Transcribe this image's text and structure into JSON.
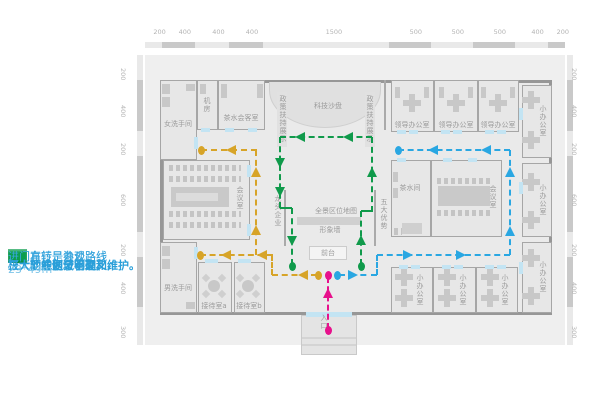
{
  "legend": {
    "items": [
      {
        "name": "office-route",
        "color": "#29abe2",
        "label": "进门右转是办公路线"
      },
      {
        "name": "negotiation-route",
        "color": "#d4a62a",
        "label": "进门左转是洽谈路线"
      },
      {
        "name": "tour-route",
        "color": "#0c9e4e",
        "label": "进门直行是参观路线"
      }
    ],
    "notes": [
      "三大动线划分明确,",
      "三大功能区域不交叉,",
      "极大的方便了管理和维护。"
    ],
    "dimensions": "23*49m"
  },
  "plan": {
    "dimensions_top": [
      200,
      400,
      400,
      400,
      1500,
      500,
      500,
      500,
      400,
      200
    ],
    "dimensions_side": [
      200,
      400,
      200,
      600,
      200,
      400,
      300
    ],
    "rooms": [
      {
        "name": "room-women-restroom",
        "label": "女洗手间",
        "x": 160,
        "y": 80,
        "w": 37,
        "h": 80,
        "o": "h",
        "lx": 178,
        "ly": 124
      },
      {
        "name": "room-machine",
        "label": "机房",
        "x": 197,
        "y": 80,
        "w": 21,
        "h": 50,
        "o": "v",
        "lx": 207,
        "ly": 105
      },
      {
        "name": "room-tea-reception",
        "label": "茶水会客室",
        "x": 218,
        "y": 80,
        "w": 47,
        "h": 50,
        "o": "h",
        "lx": 241,
        "ly": 118
      },
      {
        "name": "room-leader-office-1",
        "label": "领导办公室",
        "x": 391,
        "y": 80,
        "w": 43,
        "h": 52,
        "o": "h",
        "lx": 412,
        "ly": 125
      },
      {
        "name": "room-leader-office-2",
        "label": "领导办公室",
        "x": 434,
        "y": 80,
        "w": 44,
        "h": 52,
        "o": "h",
        "lx": 456,
        "ly": 125
      },
      {
        "name": "room-leader-office-3",
        "label": "领导办公室",
        "x": 478,
        "y": 80,
        "w": 41,
        "h": 52,
        "o": "h",
        "lx": 498,
        "ly": 125
      },
      {
        "name": "room-small-office-top-right",
        "label": "小办公室",
        "x": 522,
        "y": 85,
        "w": 30,
        "h": 73,
        "o": "v",
        "lx": 543,
        "ly": 121
      },
      {
        "name": "room-conference-left",
        "label": "会议室",
        "x": 163,
        "y": 160,
        "w": 87,
        "h": 80,
        "o": "v",
        "lx": 240,
        "ly": 198
      },
      {
        "name": "room-tea",
        "label": "茶水间",
        "x": 391,
        "y": 160,
        "w": 40,
        "h": 77,
        "o": "h",
        "lx": 410,
        "ly": 188
      },
      {
        "name": "room-conference-right",
        "label": "会议室",
        "x": 431,
        "y": 160,
        "w": 71,
        "h": 77,
        "o": "v",
        "lx": 493,
        "ly": 197
      },
      {
        "name": "room-small-office-mid-right",
        "label": "小办公室",
        "x": 522,
        "y": 163,
        "w": 30,
        "h": 74,
        "o": "v",
        "lx": 543,
        "ly": 200
      },
      {
        "name": "room-men-restroom",
        "label": "男洗手间",
        "x": 160,
        "y": 242,
        "w": 37,
        "h": 71,
        "o": "h",
        "lx": 178,
        "ly": 288
      },
      {
        "name": "room-reception-a",
        "label": "接待室a",
        "x": 198,
        "y": 262,
        "w": 34,
        "h": 51,
        "o": "h",
        "lx": 214,
        "ly": 306
      },
      {
        "name": "room-reception-b",
        "label": "接待室b",
        "x": 234,
        "y": 262,
        "w": 31,
        "h": 51,
        "o": "h",
        "lx": 249,
        "ly": 306
      },
      {
        "name": "room-small-office-b1",
        "label": "小办公室",
        "x": 391,
        "y": 267,
        "w": 42,
        "h": 46,
        "o": "v",
        "lx": 420,
        "ly": 290
      },
      {
        "name": "room-small-office-b2",
        "label": "小办公室",
        "x": 433,
        "y": 267,
        "w": 43,
        "h": 46,
        "o": "v",
        "lx": 463,
        "ly": 290
      },
      {
        "name": "room-small-office-b3",
        "label": "小办公室",
        "x": 476,
        "y": 267,
        "w": 42,
        "h": 46,
        "o": "v",
        "lx": 505,
        "ly": 290
      },
      {
        "name": "room-small-office-bottom-right",
        "label": "小办公室",
        "x": 522,
        "y": 242,
        "w": 30,
        "h": 71,
        "o": "v",
        "lx": 543,
        "ly": 277
      }
    ],
    "area_labels": [
      {
        "name": "label-tech-sandbox",
        "text": "科技沙盘",
        "x": 328,
        "y": 106,
        "o": "h"
      },
      {
        "name": "label-policy-display-left",
        "text": "政策扶持展示",
        "x": 283,
        "y": 119,
        "o": "v"
      },
      {
        "name": "label-policy-display-right",
        "text": "政策扶持展示",
        "x": 370,
        "y": 119,
        "o": "v"
      },
      {
        "name": "label-leading-enterprise",
        "text": "龙头企业",
        "x": 278,
        "y": 211,
        "o": "v"
      },
      {
        "name": "label-five-advantages",
        "text": "五大优势",
        "x": 384,
        "y": 214,
        "o": "v"
      },
      {
        "name": "label-panorama-map",
        "text": "全景区位地图",
        "x": 336,
        "y": 211,
        "o": "h"
      },
      {
        "name": "label-image-wall",
        "text": "形象墙",
        "x": 330,
        "y": 230,
        "o": "h"
      },
      {
        "name": "label-front-desk",
        "text": "前台",
        "x": 328,
        "y": 253,
        "o": "h"
      },
      {
        "name": "label-entrance",
        "text": "入口",
        "x": 324,
        "y": 322,
        "o": "v"
      }
    ],
    "features": [
      {
        "name": "entrance-vestibule",
        "t": "rect",
        "x": 301,
        "y": 315,
        "w": 56,
        "h": 40,
        "c": "#e4e4e4",
        "br": "#c9c9c9"
      },
      {
        "name": "vestibule-step",
        "t": "rect",
        "x": 302,
        "y": 337,
        "w": 54,
        "h": 2,
        "c": "#d4d4d4"
      },
      {
        "name": "vestibule-step",
        "t": "rect",
        "x": 302,
        "y": 344,
        "w": 54,
        "h": 2,
        "c": "#d4d4d4"
      },
      {
        "name": "tech-sandbox-stage",
        "t": "arch",
        "x": 269,
        "y": 82,
        "w": 112,
        "h": 46
      },
      {
        "name": "display-wall-left",
        "t": "rect",
        "x": 277,
        "y": 92,
        "w": 10,
        "h": 55,
        "c": "#e1e1e1"
      },
      {
        "name": "display-wall-right",
        "t": "rect",
        "x": 365,
        "y": 92,
        "w": 10,
        "h": 55,
        "c": "#e1e1e1"
      },
      {
        "name": "hall-wall-right",
        "t": "rect",
        "x": 384,
        "y": 80,
        "w": 2,
        "h": 50,
        "c": "#aaaaaa"
      },
      {
        "name": "hall-wall-stub-left",
        "t": "rect",
        "x": 284,
        "y": 190,
        "w": 2,
        "h": 56,
        "c": "#aaaaaa"
      },
      {
        "name": "hall-wall-stub-right",
        "t": "rect",
        "x": 374,
        "y": 190,
        "w": 2,
        "h": 56,
        "c": "#aaaaaa"
      },
      {
        "name": "image-wall",
        "t": "rect",
        "x": 297,
        "y": 217,
        "w": 64,
        "h": 8,
        "c": "#d0d0d0"
      },
      {
        "name": "front-desk",
        "t": "rect",
        "x": 309,
        "y": 246,
        "w": 38,
        "h": 14,
        "c": "#f4f4f4",
        "br": "#cccccc"
      },
      {
        "name": "entrance-door",
        "t": "rect",
        "x": 306,
        "y": 312,
        "w": 46,
        "h": 5,
        "c": "#c3e4f3"
      }
    ],
    "furniture": [
      {
        "t": "strip",
        "x": 169,
        "y": 165,
        "w": 72,
        "h": 6
      },
      {
        "t": "strip",
        "x": 169,
        "y": 176,
        "w": 72,
        "h": 6
      },
      {
        "t": "rect",
        "x": 171,
        "y": 187,
        "w": 58,
        "h": 20,
        "c": "#c9c9c9"
      },
      {
        "t": "rect",
        "x": 176,
        "y": 193,
        "w": 42,
        "h": 8,
        "c": "#dcdcdc"
      },
      {
        "t": "strip",
        "x": 169,
        "y": 211,
        "w": 72,
        "h": 6
      },
      {
        "t": "strip",
        "x": 169,
        "y": 222,
        "w": 72,
        "h": 6
      },
      {
        "t": "strip",
        "x": 437,
        "y": 178,
        "w": 54,
        "h": 6
      },
      {
        "t": "rect",
        "x": 438,
        "y": 186,
        "w": 52,
        "h": 20,
        "c": "#c9c9c9"
      },
      {
        "t": "strip",
        "x": 437,
        "y": 210,
        "w": 54,
        "h": 6
      },
      {
        "t": "plus",
        "x": 412,
        "y": 103
      },
      {
        "t": "rect",
        "x": 395,
        "y": 87,
        "w": 5,
        "h": 11
      },
      {
        "t": "rect",
        "x": 424,
        "y": 87,
        "w": 5,
        "h": 11
      },
      {
        "t": "plus",
        "x": 456,
        "y": 103
      },
      {
        "t": "rect",
        "x": 439,
        "y": 87,
        "w": 5,
        "h": 11
      },
      {
        "t": "rect",
        "x": 468,
        "y": 87,
        "w": 5,
        "h": 11
      },
      {
        "t": "plus",
        "x": 498,
        "y": 103
      },
      {
        "t": "rect",
        "x": 481,
        "y": 87,
        "w": 5,
        "h": 11
      },
      {
        "t": "rect",
        "x": 510,
        "y": 87,
        "w": 5,
        "h": 11
      },
      {
        "t": "plus",
        "x": 531,
        "y": 100
      },
      {
        "t": "plus",
        "x": 531,
        "y": 140
      },
      {
        "t": "plus",
        "x": 531,
        "y": 182
      },
      {
        "t": "plus",
        "x": 531,
        "y": 220
      },
      {
        "t": "plus",
        "x": 531,
        "y": 258
      },
      {
        "t": "plus",
        "x": 531,
        "y": 296
      },
      {
        "t": "plus",
        "x": 404,
        "y": 277
      },
      {
        "t": "plus",
        "x": 404,
        "y": 298
      },
      {
        "t": "plus",
        "x": 447,
        "y": 277
      },
      {
        "t": "plus",
        "x": 447,
        "y": 298
      },
      {
        "t": "plus",
        "x": 490,
        "y": 277
      },
      {
        "t": "plus",
        "x": 490,
        "y": 298
      },
      {
        "t": "circle",
        "x": 214,
        "y": 286,
        "r": 6
      },
      {
        "t": "diam",
        "x": 206,
        "y": 278
      },
      {
        "t": "diam",
        "x": 222,
        "y": 278
      },
      {
        "t": "diam",
        "x": 206,
        "y": 294
      },
      {
        "t": "diam",
        "x": 222,
        "y": 294
      },
      {
        "t": "circle",
        "x": 248,
        "y": 286,
        "r": 6
      },
      {
        "t": "diam",
        "x": 240,
        "y": 278
      },
      {
        "t": "diam",
        "x": 256,
        "y": 278
      },
      {
        "t": "diam",
        "x": 240,
        "y": 294
      },
      {
        "t": "diam",
        "x": 256,
        "y": 294
      },
      {
        "t": "rect",
        "x": 393,
        "y": 172,
        "w": 5,
        "h": 10
      },
      {
        "t": "rect",
        "x": 393,
        "y": 188,
        "w": 5,
        "h": 10
      },
      {
        "t": "rect",
        "x": 402,
        "y": 223,
        "w": 20,
        "h": 11,
        "c": "#cfcfcf"
      },
      {
        "t": "strip",
        "x": 394,
        "y": 228,
        "w": 8,
        "h": 7
      },
      {
        "t": "rect",
        "x": 162,
        "y": 84,
        "w": 8,
        "h": 10
      },
      {
        "t": "rect",
        "x": 162,
        "y": 97,
        "w": 8,
        "h": 10
      },
      {
        "t": "rect",
        "x": 186,
        "y": 84,
        "w": 9,
        "h": 7
      },
      {
        "t": "rect",
        "x": 162,
        "y": 246,
        "w": 8,
        "h": 10
      },
      {
        "t": "rect",
        "x": 162,
        "y": 259,
        "w": 8,
        "h": 10
      },
      {
        "t": "rect",
        "x": 186,
        "y": 302,
        "w": 9,
        "h": 7
      },
      {
        "t": "rect",
        "x": 221,
        "y": 84,
        "w": 6,
        "h": 14
      },
      {
        "t": "rect",
        "x": 257,
        "y": 84,
        "w": 6,
        "h": 14
      },
      {
        "t": "rect",
        "x": 200,
        "y": 84,
        "w": 6,
        "h": 10
      }
    ],
    "doors": [
      [
        205,
        259,
        13,
        4
      ],
      [
        238,
        259,
        13,
        4
      ],
      [
        194,
        247,
        4,
        12
      ],
      [
        194,
        137,
        4,
        12
      ],
      [
        201,
        128,
        9,
        4
      ],
      [
        225,
        128,
        9,
        4
      ],
      [
        248,
        128,
        9,
        4
      ],
      [
        397,
        130,
        9,
        4
      ],
      [
        409,
        130,
        9,
        4
      ],
      [
        441,
        130,
        9,
        4
      ],
      [
        453,
        130,
        9,
        4
      ],
      [
        485,
        130,
        9,
        4
      ],
      [
        497,
        130,
        9,
        4
      ],
      [
        519,
        108,
        4,
        12
      ],
      [
        519,
        182,
        4,
        12
      ],
      [
        519,
        262,
        4,
        12
      ],
      [
        397,
        158,
        9,
        4
      ],
      [
        443,
        158,
        9,
        4
      ],
      [
        468,
        158,
        9,
        4
      ],
      [
        399,
        265,
        9,
        4
      ],
      [
        411,
        265,
        9,
        4
      ],
      [
        442,
        265,
        9,
        4
      ],
      [
        454,
        265,
        9,
        4
      ],
      [
        485,
        265,
        9,
        4
      ],
      [
        497,
        265,
        9,
        4
      ],
      [
        247,
        165,
        4,
        12
      ],
      [
        247,
        224,
        4,
        12
      ]
    ],
    "routes": [
      {
        "name": "route-office-line",
        "color": "#2aa7e2",
        "segs": [
          [
            339,
            275,
            377,
            275
          ],
          [
            377,
            255,
            377,
            275
          ],
          [
            377,
            255,
            510,
            255
          ],
          [
            510,
            150,
            510,
            255
          ],
          [
            398,
            150,
            510,
            150
          ]
        ],
        "arrows": [
          [
            353,
            275,
            "right"
          ],
          [
            408,
            255,
            "right"
          ],
          [
            461,
            255,
            "right"
          ],
          [
            510,
            231,
            "up"
          ],
          [
            510,
            172,
            "up"
          ],
          [
            486,
            150,
            "left"
          ],
          [
            433,
            150,
            "left"
          ]
        ],
        "dots": [
          [
            337,
            275
          ],
          [
            398,
            150
          ]
        ]
      },
      {
        "name": "route-negotiation-line",
        "color": "#d7a428",
        "segs": [
          [
            272,
            275,
            317,
            275
          ],
          [
            272,
            255,
            272,
            275
          ],
          [
            200,
            255,
            273,
            255
          ],
          [
            256,
            150,
            256,
            255
          ],
          [
            201,
            150,
            257,
            150
          ]
        ],
        "arrows": [
          [
            303,
            275,
            "left"
          ],
          [
            262,
            255,
            "left"
          ],
          [
            226,
            255,
            "left"
          ],
          [
            256,
            230,
            "up"
          ],
          [
            256,
            172,
            "up"
          ],
          [
            231,
            150,
            "left"
          ]
        ],
        "dots": [
          [
            318,
            275
          ],
          [
            200,
            255
          ],
          [
            201,
            150
          ]
        ]
      },
      {
        "name": "route-tour-line",
        "color": "#109a4b",
        "segs": [
          [
            361,
            211,
            361,
            265
          ],
          [
            361,
            211,
            372,
            211
          ],
          [
            372,
            137,
            372,
            212
          ],
          [
            280,
            137,
            372,
            137
          ],
          [
            280,
            137,
            280,
            208
          ],
          [
            280,
            208,
            292,
            208
          ],
          [
            292,
            208,
            292,
            265
          ]
        ],
        "arrows": [
          [
            361,
            240,
            "up"
          ],
          [
            372,
            172,
            "up"
          ],
          [
            348,
            137,
            "left"
          ],
          [
            300,
            137,
            "left"
          ],
          [
            280,
            163,
            "down"
          ],
          [
            280,
            192,
            "down"
          ],
          [
            292,
            241,
            "down"
          ]
        ],
        "dots": [
          [
            361,
            266
          ],
          [
            292,
            266
          ]
        ]
      },
      {
        "name": "route-entrance-line",
        "color": "#e7118c",
        "segs": [
          [
            328,
            277,
            328,
            329
          ]
        ],
        "arrows": [
          [
            328,
            293,
            "up"
          ]
        ],
        "dots": [
          [
            328,
            330
          ],
          [
            328,
            275
          ]
        ]
      }
    ]
  }
}
